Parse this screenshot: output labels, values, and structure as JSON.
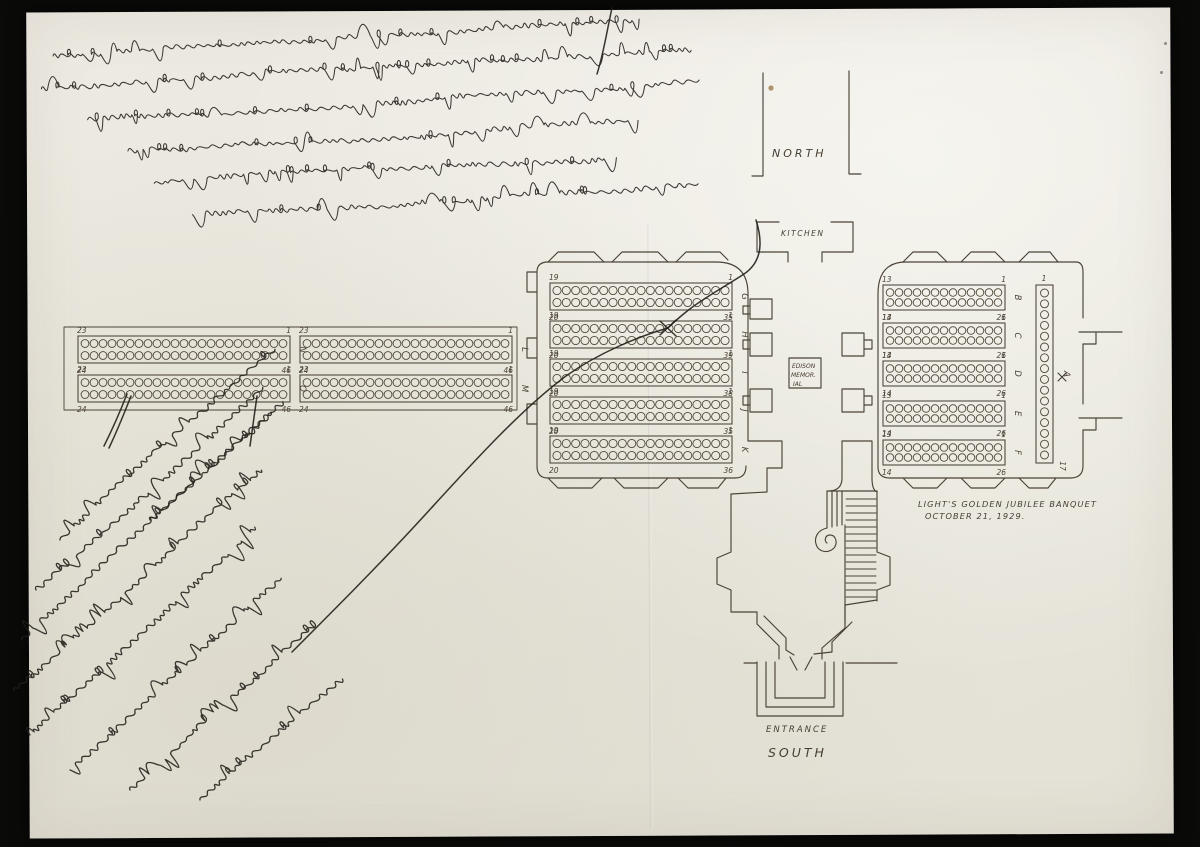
{
  "scan": {
    "background_color": "#0a0a09",
    "paper_color": "#e9e7de",
    "ink_color": "#221f1a",
    "pencil_color": "#4b4337",
    "artifacts": [
      "vertical fold crease",
      "foxing dot upper center",
      "specks on black scan border"
    ]
  },
  "plan": {
    "north_label": "NORTH",
    "kitchen_label": "KITCHEN",
    "memorial_lines": [
      "EDISON",
      "MEMOR.",
      "IAL"
    ],
    "entrance_label": "ENTRANCE",
    "south_label": "SOUTH",
    "caption_line1": "LIGHT'S GOLDEN JUBILEE BANQUET",
    "caption_line2": "OCTOBER 21, 1929.",
    "head_table": {
      "letter": "A",
      "top_number": "1",
      "bottom_number": "17",
      "seats_drawn": 16
    },
    "tables": [
      {
        "letter": "B",
        "area": "east-hall",
        "tl": "13",
        "tr": "1",
        "bl": "14",
        "br": "26",
        "seats_per_row": 13
      },
      {
        "letter": "C",
        "area": "east-hall",
        "tl": "13",
        "tr": "1",
        "bl": "14",
        "br": "26",
        "seats_per_row": 13
      },
      {
        "letter": "D",
        "area": "east-hall",
        "tl": "13",
        "tr": "1",
        "bl": "14",
        "br": "26",
        "seats_per_row": 13
      },
      {
        "letter": "E",
        "area": "east-hall",
        "tl": "13",
        "tr": "1",
        "bl": "14",
        "br": "26",
        "seats_per_row": 13
      },
      {
        "letter": "F",
        "area": "east-hall",
        "tl": "13",
        "tr": "1",
        "bl": "14",
        "br": "26",
        "seats_per_row": 13
      },
      {
        "letter": "G",
        "area": "center-hall",
        "tl": "19",
        "tr": "1",
        "bl": "20",
        "br": "35",
        "seats_per_row": 19
      },
      {
        "letter": "H",
        "area": "center-hall",
        "tl": "19",
        "tr": "1",
        "bl": "20",
        "br": "39",
        "seats_per_row": 19
      },
      {
        "letter": "I",
        "area": "center-hall",
        "tl": "19",
        "tr": "1",
        "bl": "20",
        "br": "38",
        "seats_per_row": 19
      },
      {
        "letter": "J",
        "area": "center-hall",
        "tl": "19",
        "tr": "1",
        "bl": "20",
        "br": "35",
        "seats_per_row": 19
      },
      {
        "letter": "K",
        "area": "center-hall",
        "tl": "19",
        "tr": "1",
        "bl": "20",
        "br": "36",
        "seats_per_row": 19
      },
      {
        "letter": "L",
        "area": "west-gallery",
        "tl": "23",
        "tr": "1",
        "bl": "24",
        "br": "46",
        "seats_per_row": 23
      },
      {
        "letter": "M",
        "area": "west-gallery",
        "tl": "23",
        "tr": "1",
        "bl": "24",
        "br": "46",
        "seats_per_row": 23
      },
      {
        "letter": "N",
        "area": "west-gallery",
        "tl": "23",
        "tr": "1",
        "bl": "24",
        "br": "46",
        "seats_per_row": 23
      },
      {
        "letter": "O",
        "area": "west-gallery",
        "tl": "23",
        "tr": "1",
        "bl": "24",
        "br": "46",
        "seats_per_row": 23
      }
    ]
  },
  "handwriting": {
    "top_note": "Illegible cursive ink note written upside-down across the top of the sheet (6 lines)",
    "bottom_note": "Illegible cursive ink note written diagonally in the lower-left corner (9 lines)",
    "connector": "Curved ink line from the diagonal note through the center hall to the kitchen, with an X marked at a seat of table H",
    "x_mark": "X"
  }
}
